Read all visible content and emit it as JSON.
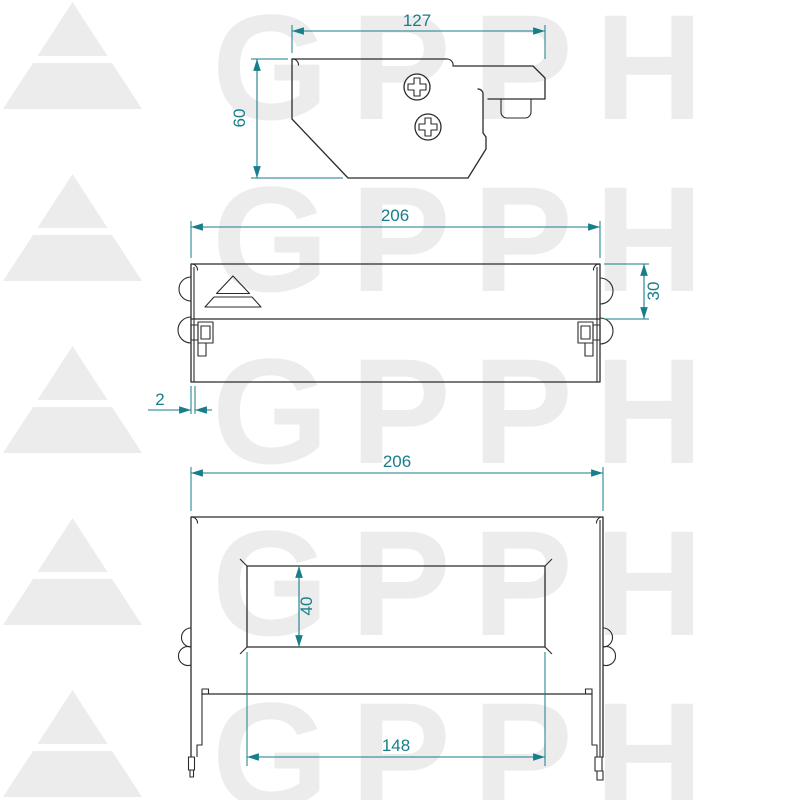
{
  "title": "GPPH bracket technical drawing",
  "watermark": {
    "text": "GPPH",
    "color": "#ececec"
  },
  "colors": {
    "outline": "#2b2b2b",
    "dimension": "#177e8a",
    "background": "#ffffff"
  },
  "views": {
    "side_profile": {
      "dims": {
        "width": "127",
        "height": "60"
      }
    },
    "front": {
      "dims": {
        "width": "206",
        "height": "30",
        "edge_offset": "2"
      }
    },
    "top": {
      "dims": {
        "width": "206",
        "slot_height": "40",
        "slot_length": "148"
      }
    }
  }
}
